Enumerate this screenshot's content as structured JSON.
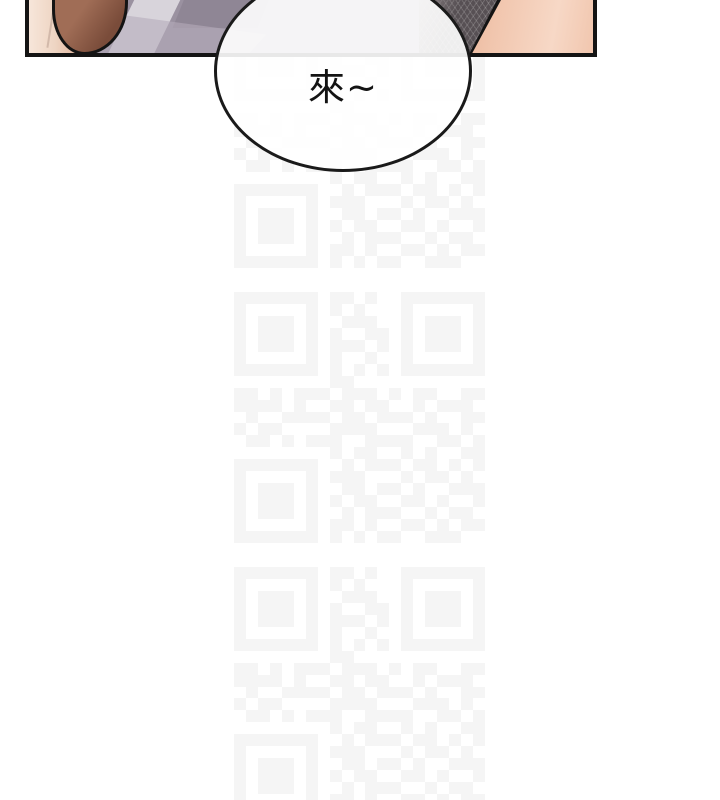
{
  "page": {
    "width": 720,
    "height": 800,
    "background": "#ffffff",
    "comic_panel": {
      "description": "bottom sliver of comic artwork panel, top edge cut off by viewport",
      "border_color": "#141414",
      "colors": {
        "outline": "#141414",
        "skin_left": "#eed5c3",
        "skin_left_highlight": "#f7e6da",
        "skin_left_deep": "#e2b9a2",
        "skin_crease": "#c4ab9d",
        "hair": "#a06d56",
        "hair_dark": "#7a4c3a",
        "wall": "#9a91a0",
        "wall_light": "#d8d4db",
        "wall_soft": "#b5acba",
        "wall_dark": "#8d8493",
        "fabric": "#575054",
        "fabric_highlight": "#8b8285",
        "skin_right": "#f1c6ae",
        "skin_right_light": "#f7d8c6",
        "skin_right_deep": "#e6aa8c"
      }
    },
    "speech_bubble": {
      "text": "來~",
      "text_color": "#131313",
      "border_color": "#1a1a1a",
      "fill": "rgba(255,255,255,0.9)"
    },
    "watermark": {
      "kind": "qr-code-pattern",
      "module_color": "#f5f5f5",
      "grid": 21,
      "tile_size": 251,
      "tiles": [
        {
          "x": 234,
          "y": 17
        },
        {
          "x": 234,
          "y": 292
        },
        {
          "x": 234,
          "y": 567
        }
      ],
      "matrix": [
        "111111101101001111111",
        "100000101010001000001",
        "101110100111001011101",
        "101110101001101011101",
        "101110101110101011101",
        "100000101001001000001",
        "111111101010101111111",
        "000000001100000000000",
        "110101110111010110011",
        "111101001101100101110",
        "010011110110111010011",
        "101100001111000111010",
        "011010111001111001101",
        "000000001011001010011",
        "111111100101110110101",
        "100000101110001011010",
        "101110100110110100111",
        "101110101011001101001",
        "101110100101110010110",
        "100000101101001101011",
        "111111101010110011100"
      ]
    }
  }
}
